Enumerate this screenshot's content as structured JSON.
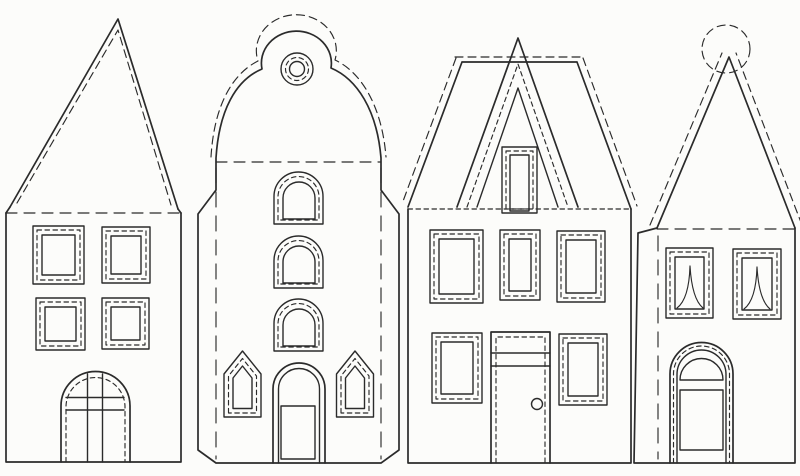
{
  "canvas": {
    "width": 800,
    "height": 476,
    "background_color": "#fcfcfa",
    "line_color": "#2b2b2b",
    "content_kind": "paper-house-craft-templates",
    "text_content": "none"
  },
  "houses": [
    {
      "name": "house-template-1",
      "roof": "steep triangular gable with inner dashed fold line",
      "windows": "four rectangular windows in 2x2 grid, triple frame with dashed middle outline",
      "door": "round-arched door with cross glazing bars and dashed inner outline"
    },
    {
      "name": "house-template-2",
      "roof": "bell-shaped curved gable with top knob and double-ring ornament, dashed outline offset outside",
      "windows": "three stacked round-arched windows plus two pointed lancet windows beside door",
      "door": "round-arched double-outline door with rectangular panel",
      "sides": "angled glue flaps with long-dash vertical fold lines"
    },
    {
      "name": "house-template-3",
      "roof": "flat-topped trapezoid roof with dashed cut offset and large A-frame gable band",
      "windows": "tall rectangular gable window, three upper windows, two lower windows, all triple-framed with dashed middle",
      "door": "rectangular door with transom band, dashed inner outline and round doorknob"
    },
    {
      "name": "house-template-4",
      "roof": "tall narrow spire with dashed circle finial at apex and dashed offsets along edges",
      "windows": "two rectangular windows with peaked drawn-curtain silhouettes",
      "door": "round-arched door with fanlight arc and rectangular panel",
      "sides": "left glue flap with long-dash vertical fold line"
    }
  ]
}
